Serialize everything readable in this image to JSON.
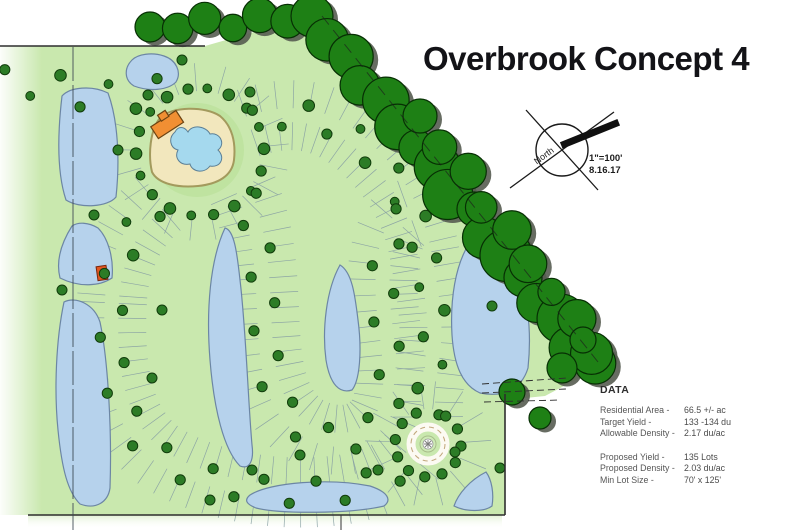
{
  "title": "Overbrook Concept 4",
  "north_arrow": {
    "label": "North"
  },
  "scale_note": {
    "scale": "1\"=100'",
    "date": "8.16.17"
  },
  "data_panel": {
    "heading": "DATA",
    "site_rows": [
      {
        "label": "Residential Area -",
        "value": "66.5 +/- ac"
      },
      {
        "label": "Target Yield -",
        "value": "133 -134 du"
      },
      {
        "label": "Allowable Density -",
        "value": "2.17 du/ac"
      }
    ],
    "proposal_rows": [
      {
        "label": "Proposed Yield -",
        "value": "135 Lots"
      },
      {
        "label": "Proposed Density -",
        "value": "2.03 du/ac"
      },
      {
        "label": "Min Lot Size -",
        "value": "70' x 125'"
      }
    ]
  },
  "map": {
    "features": {
      "tree_canopy": "preserved perimeter tree canopy",
      "ponds": "stormwater ponds",
      "lots": "single-family lots along looped streets",
      "streets": "curvilinear residential streets with street trees",
      "amenity": "amenity center with pool",
      "cul_de_sac": "cul-de-sac with landscaped roundabout",
      "entry": "boulevard entry from the west"
    },
    "colors": {
      "ground": "#c9e8ae",
      "lot": "#e1f0e7",
      "pond": "#b6d2ec",
      "canopy": "#1e8015",
      "canopy_shadow": "#565c51",
      "street_tree": "#2c7c26",
      "street_tree_edge": "#113c0b",
      "road": "#fcfaf2",
      "amenity_sand": "#f2e7bd",
      "pool": "#a5d9ee",
      "building_orange": "#f18f33",
      "building_red": "#e2571f"
    }
  }
}
